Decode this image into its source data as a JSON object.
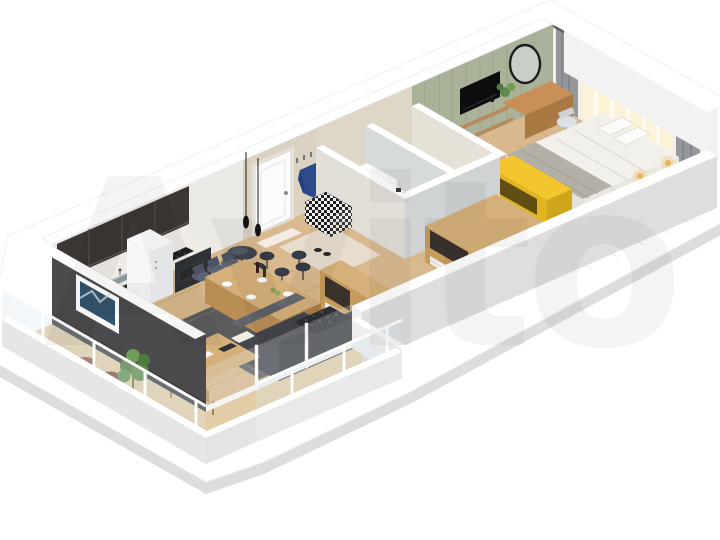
{
  "watermark": {
    "text": "Avito"
  },
  "scene": {
    "type": "isometric-3d-floor-plan-render",
    "view": "cutaway apartment seen from above at an angle, on white background",
    "rooms": [
      {
        "name": "living-room-kitchen",
        "furniture": [
          "dark-upper-cabinets",
          "marble-backsplash",
          "marble-counter",
          "steel-sink",
          "black-cooktop",
          "white-retro-fridge",
          "pendant-lights",
          "dining-table",
          "upholstered-chairs",
          "wine-bottles",
          "plates",
          "round-bar-table",
          "bar-stools",
          "writing-desk",
          "white-chair",
          "papers",
          "dark-sofa",
          "dark-tufted-throw",
          "dark-rug",
          "wood-sideboard"
        ]
      },
      {
        "name": "hallway",
        "furniture": [
          "white-entry-door",
          "door-mat",
          "beige-rug",
          "slippers",
          "checkered-storage-bench",
          "coat-hooks",
          "blue-jacket"
        ]
      },
      {
        "name": "bathroom-wc",
        "furniture": [
          "white-vanity-sink"
        ]
      },
      {
        "name": "bathroom-bath",
        "furniture": [
          "white-bathtub"
        ]
      },
      {
        "name": "corridor",
        "furniture": [
          "wood-dresser-open-shelves"
        ]
      },
      {
        "name": "bedroom",
        "furniture": [
          "green-panel-wall",
          "wall-tv",
          "wood-wall-shelves",
          "round-black-mirror",
          "wood-vanity-desk",
          "desk-chair",
          "desk-plant",
          "double-bed-white-bedding",
          "pillows",
          "gray-plaid",
          "yellow-tv-stand",
          "window-with-curtains",
          "gray-drapes",
          "warm-light-glow",
          "wall-lamps"
        ]
      },
      {
        "name": "balcony-lounge",
        "furniture": [
          "glazed-parapet",
          "white-mullions",
          "dark-accent-wall",
          "framed-abstract-picture",
          "floor-plant",
          "brown-poufs"
        ]
      }
    ]
  },
  "colors": {
    "wall_top": "#ffffff",
    "slab_edge": "#d9d9d9",
    "wall_outer": "#dedede",
    "wall_inner": "#efeeec",
    "floor_wood": "#d8b88c",
    "floor_balcony": "#e2cda6",
    "accent_wall_dark": "#4b4b4d",
    "accent_wall_green": "#aab399",
    "hall_wall_beige": "#dbd2c2",
    "bath_wall_gray": "#cfd3d4",
    "cabinet_dark": "#3c3734",
    "counter_marble": "#efece7",
    "base_cabinet_dark": "#2f3234",
    "sofa_dark": "#44464c",
    "rug_dark": "#4f5156",
    "wood_furniture": "#d5b07a",
    "accent_yellow": "#f4c62e",
    "jacket_navy": "#2d4a8a",
    "bed_white": "#f2f0ea",
    "plaid_gray": "#b5b0a7",
    "drape_gray": "#94969a",
    "glow_warm": "#fdf2d8",
    "plant_green": "#5d8a4a",
    "pouf_brown": "#7b4a3a",
    "watermark_color": "rgba(0,0,0,0.042)"
  }
}
